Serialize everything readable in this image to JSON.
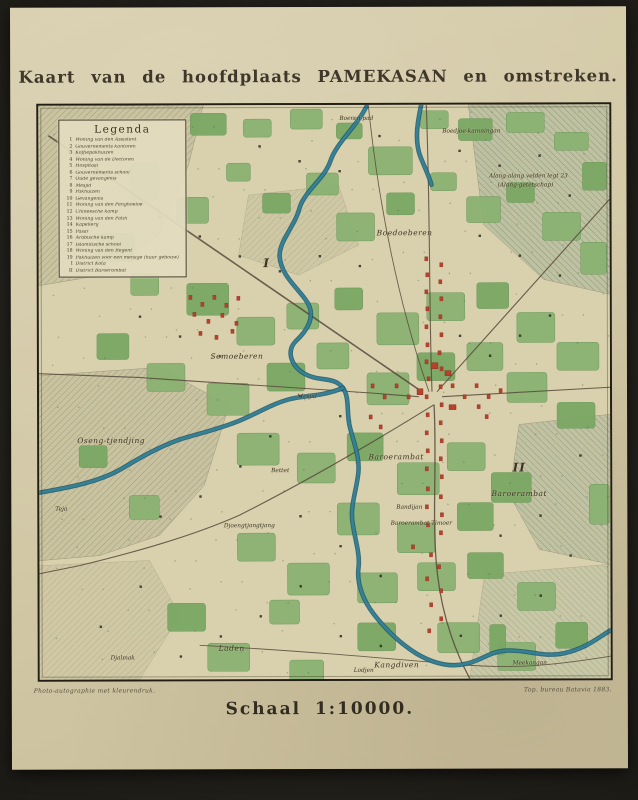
{
  "title": "Kaart van de hoofdplaats PAMEKASAN en omstreken.",
  "scale": "Schaal 1:10000.",
  "imprint_left": "Photo-autographie met kleurendruk.",
  "imprint_right": "Top. bureau Batavia 1883.",
  "legend": {
    "title": "Legenda",
    "items": [
      {
        "n": "1",
        "label": "Woning van den Assistent"
      },
      {
        "n": "2",
        "label": "Gouvernements kantoren"
      },
      {
        "n": "3",
        "label": "Koffiepakhuizen"
      },
      {
        "n": "4",
        "label": "Woning van de Doctoren"
      },
      {
        "n": "5",
        "label": "Hospitaal"
      },
      {
        "n": "6",
        "label": "Gouvernements school"
      },
      {
        "n": "7",
        "label": "Oude gevangenis"
      },
      {
        "n": "8",
        "label": "Mesjid"
      },
      {
        "n": "9",
        "label": "Pakhuizen"
      },
      {
        "n": "10",
        "label": "Gevangenis"
      },
      {
        "n": "11",
        "label": "Woning van den Panghoeloe"
      },
      {
        "n": "12",
        "label": "Chineesche kamp"
      },
      {
        "n": "13",
        "label": "Woning van den Patih"
      },
      {
        "n": "14",
        "label": "Kapellerij"
      },
      {
        "n": "15",
        "label": "Pasar"
      },
      {
        "n": "16",
        "label": "Arabische kamp"
      },
      {
        "n": "17",
        "label": "Islamitische school"
      },
      {
        "n": "18",
        "label": "Woning van den Regent"
      },
      {
        "n": "19",
        "label": "Pakhuizen voor een menage (huur gebouw)"
      },
      {
        "n": "I",
        "label": "District Kota"
      },
      {
        "n": "II",
        "label": "District Baroerambat"
      }
    ]
  },
  "map": {
    "colors": {
      "paper": "#d5cba9",
      "map_background": "#d9d1ae",
      "gardens_green": "#8ab272",
      "river_teal": "#35849a",
      "buildings_red": "#b8402c",
      "frame": "#241f16"
    },
    "labels": [
      {
        "text": "Boeren-pad",
        "x": 318,
        "y": 14,
        "style": "tiny"
      },
      {
        "text": "Boedjoe-kamningan",
        "x": 433,
        "y": 27,
        "style": "tiny"
      },
      {
        "text": "Alang-alang velden legt 23",
        "x": 490,
        "y": 72,
        "style": "tiny"
      },
      {
        "text": "(Alang-getetschap)",
        "x": 487,
        "y": 81,
        "style": "tiny"
      },
      {
        "text": "Boedoeberen",
        "x": 366,
        "y": 128,
        "style": "small"
      },
      {
        "text": "I",
        "x": 228,
        "y": 158,
        "style": "roman"
      },
      {
        "text": "Semoeberen",
        "x": 198,
        "y": 251,
        "style": "small"
      },
      {
        "text": "Mesjid",
        "x": 268,
        "y": 292,
        "style": "tiny"
      },
      {
        "text": "Oseng-tjendjing",
        "x": 72,
        "y": 335,
        "style": "small"
      },
      {
        "text": "Baroerambat",
        "x": 357,
        "y": 352,
        "style": "small"
      },
      {
        "text": "Bettet",
        "x": 241,
        "y": 366,
        "style": "tiny"
      },
      {
        "text": "II",
        "x": 480,
        "y": 363,
        "style": "roman"
      },
      {
        "text": "Baroerambat",
        "x": 480,
        "y": 389,
        "style": "small"
      },
      {
        "text": "Bandijan",
        "x": 370,
        "y": 403,
        "style": "tiny"
      },
      {
        "text": "Baroerambat Timoer",
        "x": 382,
        "y": 419,
        "style": "tiny"
      },
      {
        "text": "Teja",
        "x": 22,
        "y": 404,
        "style": "tiny"
      },
      {
        "text": "Djoengtjangtjang",
        "x": 210,
        "y": 421,
        "style": "tiny"
      },
      {
        "text": "Laden",
        "x": 192,
        "y": 543,
        "style": "small"
      },
      {
        "text": "Djalmak",
        "x": 83,
        "y": 553,
        "style": "tiny"
      },
      {
        "text": "Lodjen",
        "x": 324,
        "y": 566,
        "style": "tiny"
      },
      {
        "text": "Kangdiven",
        "x": 357,
        "y": 560,
        "style": "small"
      },
      {
        "text": "Meekangan",
        "x": 490,
        "y": 559,
        "style": "tiny"
      }
    ]
  }
}
